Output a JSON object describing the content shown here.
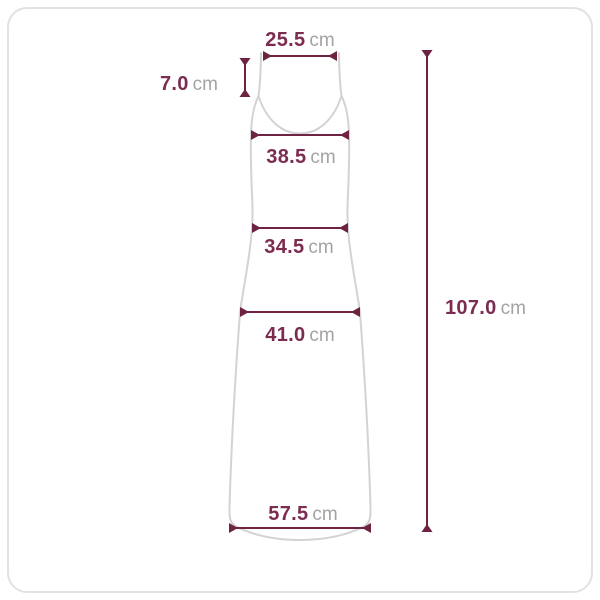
{
  "measurements": {
    "shoulder_width": {
      "value": "25.5",
      "unit": "cm"
    },
    "strap_length": {
      "value": "7.0",
      "unit": "cm"
    },
    "bust_width": {
      "value": "38.5",
      "unit": "cm"
    },
    "waist_width": {
      "value": "34.5",
      "unit": "cm"
    },
    "hip_width": {
      "value": "41.0",
      "unit": "cm"
    },
    "hem_width": {
      "value": "57.5",
      "unit": "cm"
    },
    "total_length": {
      "value": "107.0",
      "unit": "cm"
    }
  },
  "colors": {
    "dimension_line": "#6e2343",
    "value_text": "#7d2c51",
    "unit_text": "#a3a3a6",
    "garment_outline": "#d3d3d5",
    "frame_border": "#e2e2e4",
    "background": "#ffffff"
  }
}
